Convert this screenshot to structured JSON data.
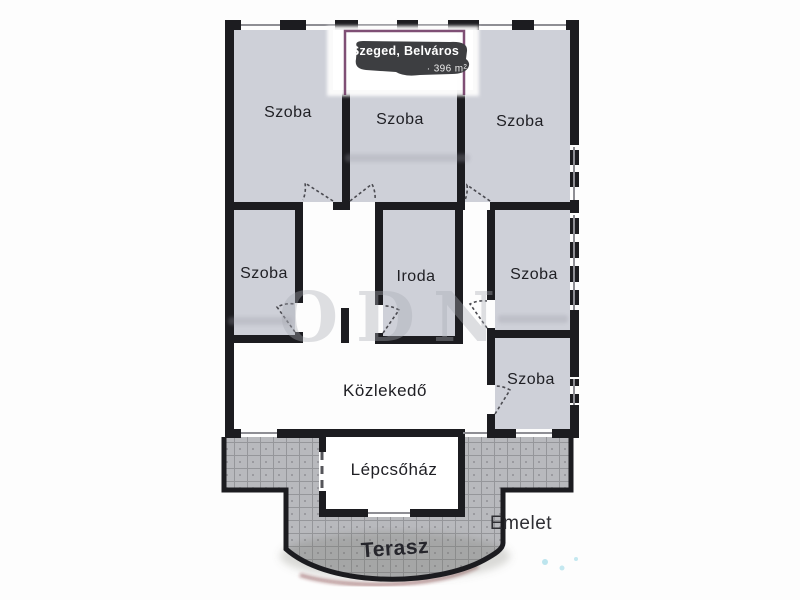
{
  "badge": {
    "location": "Szeged, Belváros",
    "area": "· 396 m²"
  },
  "rooms": {
    "top_left": "Szoba",
    "top_middle": "Szoba",
    "top_right": "Szoba",
    "mid_left": "Szoba",
    "office": "Iroda",
    "mid_right": "Szoba",
    "lower_right": "Szoba"
  },
  "areas": {
    "hallway": "Közlekedő",
    "stairwell": "Lépcsőház",
    "terrace": "Terasz",
    "floor": "Emelet"
  },
  "watermark": {
    "text": "ODN"
  },
  "colors": {
    "wall": "#1c1c20",
    "room_fill": "#ced0d8",
    "terrace_fill": "#b8b9bd",
    "badge_bg": "#3d3e41",
    "badge_text": "#ffffff",
    "artifact_purple": "#5f2352",
    "label_text": "#1f1f24"
  }
}
